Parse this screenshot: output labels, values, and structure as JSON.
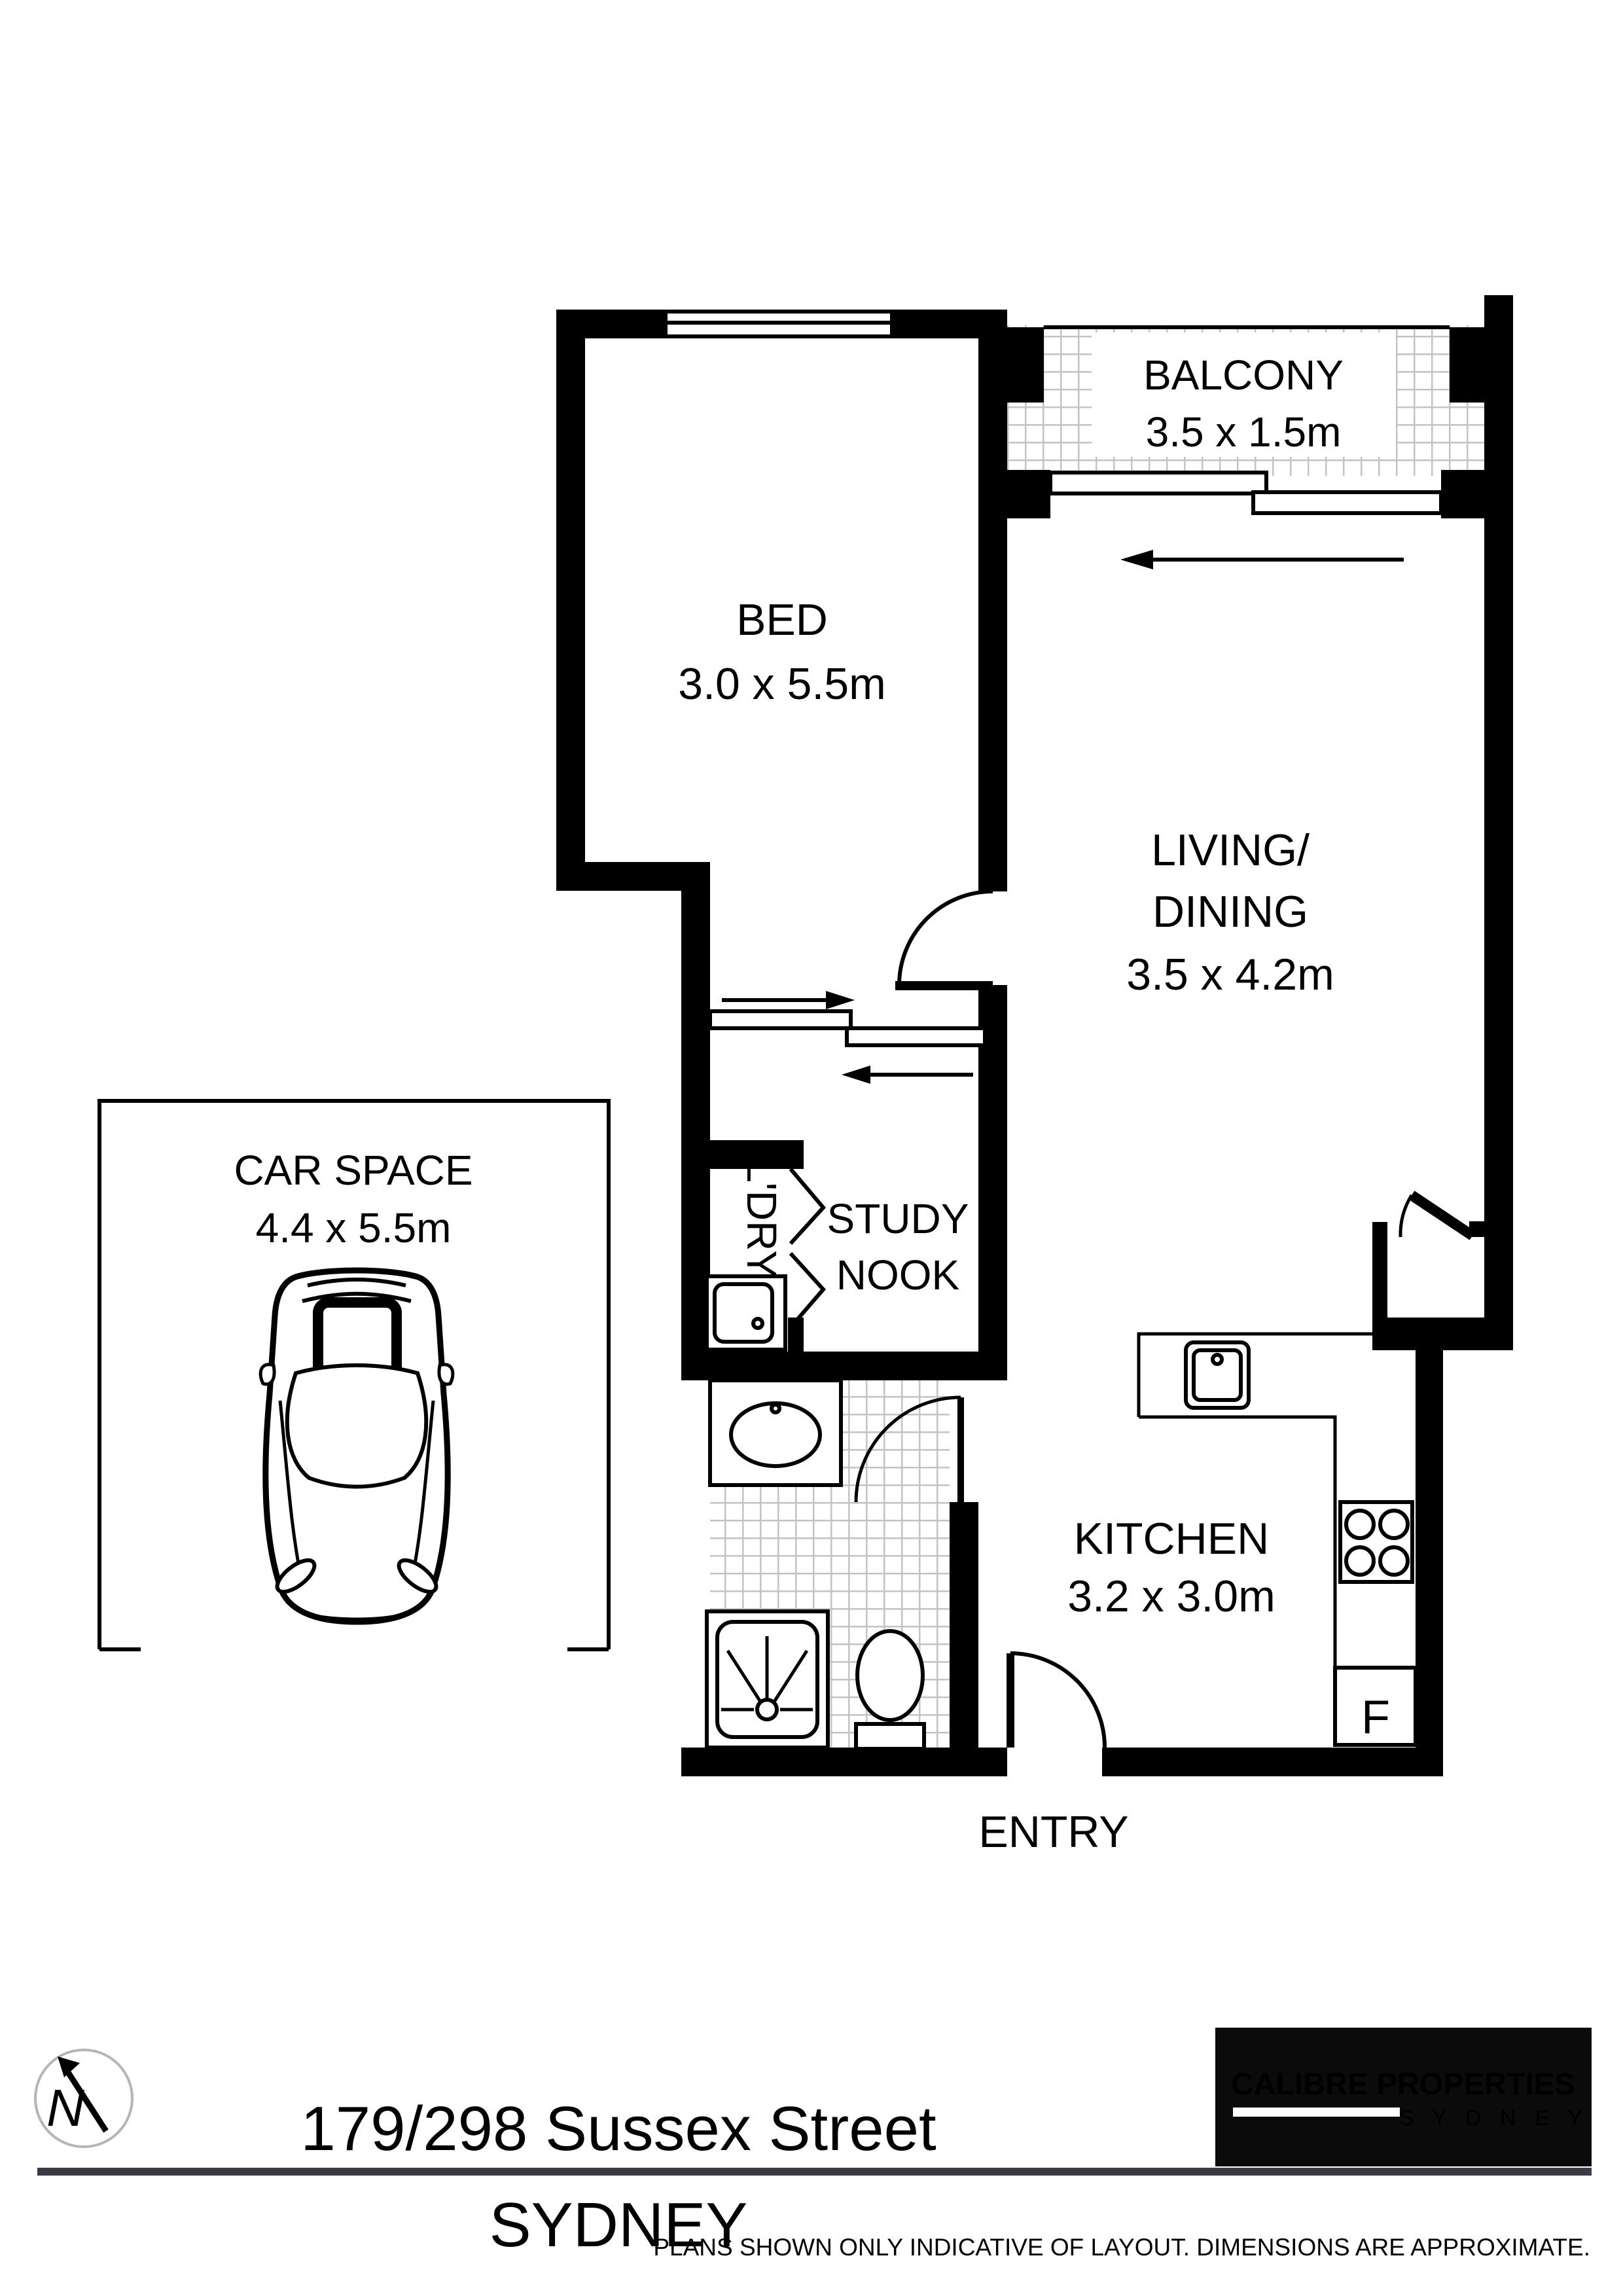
{
  "title": "Floor plan - 179/298 Sussex Street Sydney",
  "rooms": {
    "balcony": {
      "name": "BALCONY",
      "dims": "3.5 x 1.5m"
    },
    "bed": {
      "name": "BED",
      "dims": "3.0 x 5.5m"
    },
    "living": {
      "line1": "LIVING/",
      "line2": "DINING",
      "dims": "3.5 x 4.2m"
    },
    "car_space": {
      "name": "CAR SPACE",
      "dims": "4.4 x 5.5m"
    },
    "laundry": {
      "name": "L'DRY"
    },
    "study_nook": {
      "line1": "STUDY",
      "line2": "NOOK"
    },
    "kitchen": {
      "name": "KITCHEN",
      "dims": "3.2 x 3.0m"
    },
    "entry": {
      "name": "ENTRY"
    },
    "fridge_label": "F"
  },
  "fixtures": [
    "balcony-sliding-door",
    "bedroom-window",
    "bedroom-cavity-slider",
    "living-hinged-door",
    "hall-niche-door",
    "bifold-laundry-door",
    "laundry-tub",
    "vanity-basin",
    "shower",
    "toilet",
    "kitchen-sink",
    "cooktop",
    "fridge",
    "entry-door",
    "car-top-view"
  ],
  "compass": {
    "icon": "north-arrow",
    "letter": "N"
  },
  "footer": {
    "address": "179/298 Sussex Street",
    "city": "SYDNEY"
  },
  "logo": {
    "brand": "CALIBRE PROPERTIES",
    "city_spaced": "S Y D N E Y"
  },
  "disclaimer": "PLANS SHOWN ONLY INDICATIVE OF LAYOUT. DIMENSIONS ARE APPROXIMATE.",
  "colors": {
    "wall": "#000000",
    "tile_line": "#c3c3c3",
    "divider_bar": "#3b3b45",
    "logo_bg": "#0b0b0b",
    "logo_red": "#e6353b",
    "compass_ring": "#b5b5b5"
  }
}
